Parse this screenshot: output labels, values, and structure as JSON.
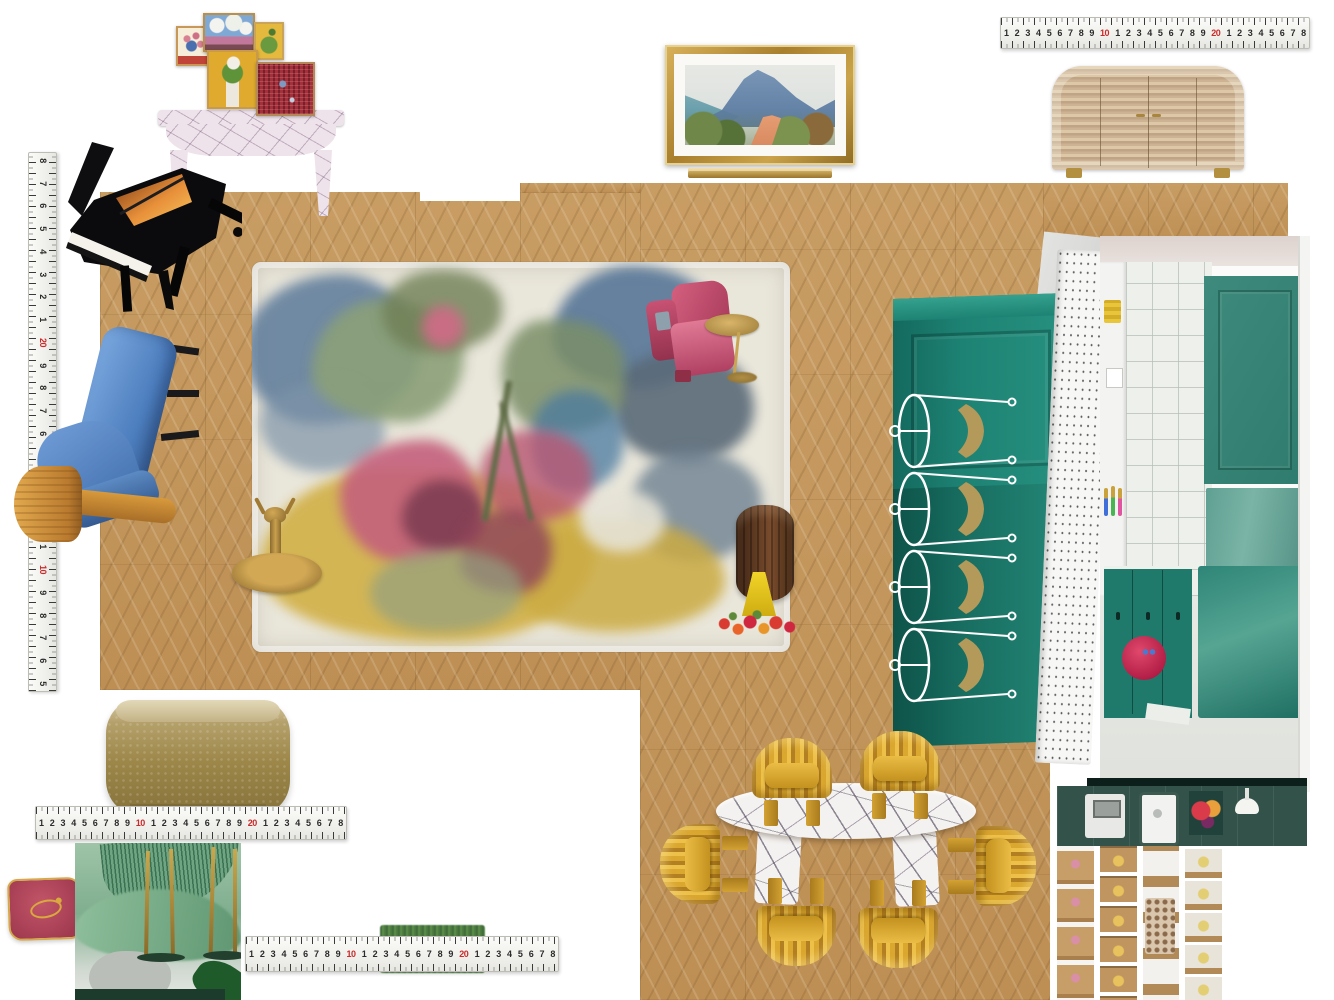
{
  "board": {
    "width": 1334,
    "height": 1000,
    "background": "#ffffff"
  },
  "rulers": {
    "red_accent_color": "#c92a2a",
    "h_sequence": [
      {
        "t": "1"
      },
      {
        "t": "2"
      },
      {
        "t": "3"
      },
      {
        "t": "4"
      },
      {
        "t": "5"
      },
      {
        "t": "6"
      },
      {
        "t": "7"
      },
      {
        "t": "8"
      },
      {
        "t": "9"
      },
      {
        "t": "10",
        "red": true
      },
      {
        "t": "1"
      },
      {
        "t": "2"
      },
      {
        "t": "3"
      },
      {
        "t": "4"
      },
      {
        "t": "5"
      },
      {
        "t": "6"
      },
      {
        "t": "7"
      },
      {
        "t": "8"
      },
      {
        "t": "9"
      },
      {
        "t": "20",
        "red": true
      },
      {
        "t": "1"
      },
      {
        "t": "2"
      },
      {
        "t": "3"
      },
      {
        "t": "4"
      },
      {
        "t": "5"
      },
      {
        "t": "6"
      },
      {
        "t": "7"
      },
      {
        "t": "8"
      }
    ],
    "v_sequence": [
      {
        "t": "8"
      },
      {
        "t": "7"
      },
      {
        "t": "6"
      },
      {
        "t": "5"
      },
      {
        "t": "4"
      },
      {
        "t": "3"
      },
      {
        "t": "2"
      },
      {
        "t": "1"
      },
      {
        "t": "20",
        "red": true
      },
      {
        "t": "9"
      },
      {
        "t": "8"
      },
      {
        "t": "7"
      },
      {
        "t": "6"
      },
      {
        "t": "5"
      },
      {
        "t": "4"
      },
      {
        "t": "3"
      },
      {
        "t": "2"
      },
      {
        "t": "1"
      },
      {
        "t": "10",
        "red": true
      },
      {
        "t": "9"
      },
      {
        "t": "8"
      },
      {
        "t": "7"
      },
      {
        "t": "6"
      },
      {
        "t": "5"
      }
    ]
  },
  "items": {
    "floor": {
      "color": "#c59a61"
    },
    "rug": {
      "base_color": "#e9e6da",
      "accent_colors": [
        "#5c7a99",
        "#8ba078",
        "#b95672",
        "#d2b149"
      ]
    },
    "grand_piano": {
      "color": "#0b0b0d",
      "interior_color": "#e8903a"
    },
    "console_table": {
      "marble_color": "#eee3ea"
    },
    "gallery_wall": {
      "frame_count": 5,
      "frame_color": "#c89a4a"
    },
    "landscape_painting": {
      "frame_color": "#c79b40"
    },
    "thin_gold_frame": {
      "color": "#c9a24a"
    },
    "sideboard": {
      "wood_color": "#cdb393",
      "feet_color": "#b29040"
    },
    "lounge_chair_blue": {
      "color": "#5b8fd0"
    },
    "mushroom_stool": {
      "color": "#cf9138"
    },
    "armchair_pink": {
      "color": "#c2486b"
    },
    "martini_table_brass": {
      "color": "#c5a050"
    },
    "tray_table_brass": {
      "color": "#b08a3e"
    },
    "drum_table_walnut": {
      "color": "#5a3720"
    },
    "vase_yellow": {
      "color": "#e3c520"
    },
    "kitchen_photo": {
      "cabinet_color": "#1d8273",
      "tile_color": "#eef0ec",
      "bowl_color": "#d1295b"
    },
    "kitchen_plan_photo": {
      "benchtop_color": "#33524a",
      "floor_color": "#c79e66"
    },
    "dining_table_marble": {
      "color": "#f4f2f0"
    },
    "dining_chairs_mustard": {
      "count": 6,
      "color": "#daa72f"
    },
    "coffee_table_brass": {
      "color": "#9c8648"
    },
    "cushion_red": {
      "color": "#b5445a",
      "piping_color": "#d4a84b"
    },
    "sofa_green_photo": {
      "color": "#7fae8e"
    },
    "hedge_strip": {
      "color": "#4c7a40"
    }
  }
}
